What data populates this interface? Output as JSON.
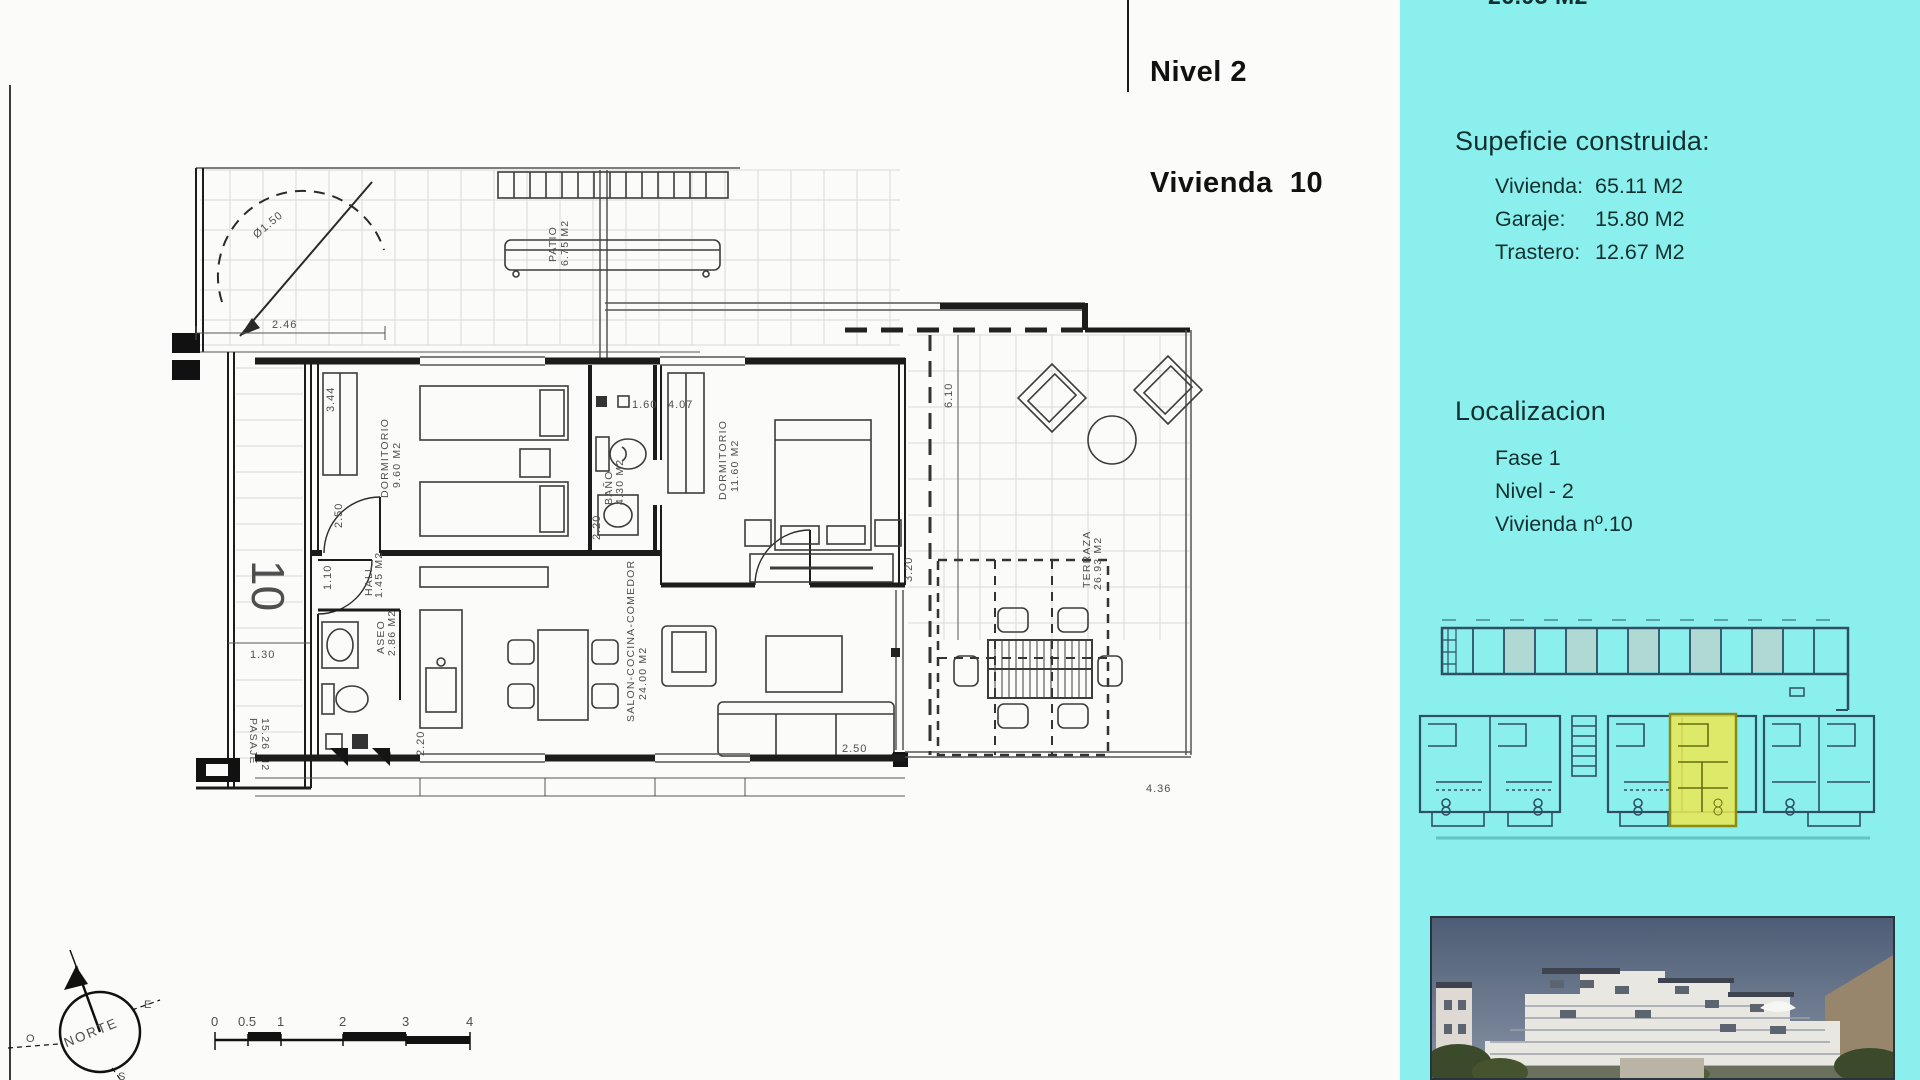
{
  "header": {
    "line1": "Nivel 2",
    "line2": "Vivienda  10"
  },
  "sidebar": {
    "clipped_top_value": "26.93 M2",
    "surface": {
      "title": "Supeficie construida:",
      "rows": [
        {
          "label": "Vivienda:",
          "value": "65.11 M2"
        },
        {
          "label": "Garaje:",
          "value": "15.80 M2"
        },
        {
          "label": "Trastero:",
          "value": "12.67 M2"
        }
      ]
    },
    "location": {
      "title": "Localizacion",
      "rows": [
        "Fase 1",
        "Nivel - 2",
        "Vivienda nº.10"
      ]
    },
    "highlight_color": "#e8e857"
  },
  "plan": {
    "unit_number": "10",
    "stair_diameter": "Ø1.50",
    "rooms": {
      "patio": {
        "name": "PATIO",
        "area": "6.75 M2"
      },
      "dormitorio1": {
        "name": "DORMITORIO",
        "area": "9.60 M2"
      },
      "bano": {
        "name": "BAÑO",
        "area": "4.30 M2"
      },
      "dormitorio2": {
        "name": "DORMITORIO",
        "area": "11.60 M2"
      },
      "salon": {
        "name": "SALON-COCINA-COMEDOR",
        "area": "24.00 M2"
      },
      "aseo": {
        "name": "ASEO",
        "area": "2.86 M2"
      },
      "hall": {
        "name": "HALL",
        "area": "1.45 M2"
      },
      "terraza": {
        "name": "TERRAZA",
        "area": "26.93 M2"
      },
      "pasaje": {
        "name": "PASAJE",
        "area": "15.26 M2"
      }
    },
    "dims": {
      "d246": "2.46",
      "d344": "3.44",
      "d250a": "2.50",
      "d110": "1.10",
      "d130": "1.30",
      "d220a": "2.20",
      "d160": "1.60",
      "d407": "4.07",
      "d610": "6.10",
      "d320": "3.20",
      "d220b": "2.20",
      "d030": ".30",
      "d250b": "2.50",
      "d436": "4.36"
    },
    "compass": {
      "north": "NORTE",
      "east": "E",
      "west": "O",
      "south": "S"
    },
    "scale_ticks": [
      "0",
      "0.5",
      "1",
      "2",
      "3",
      "4"
    ]
  }
}
